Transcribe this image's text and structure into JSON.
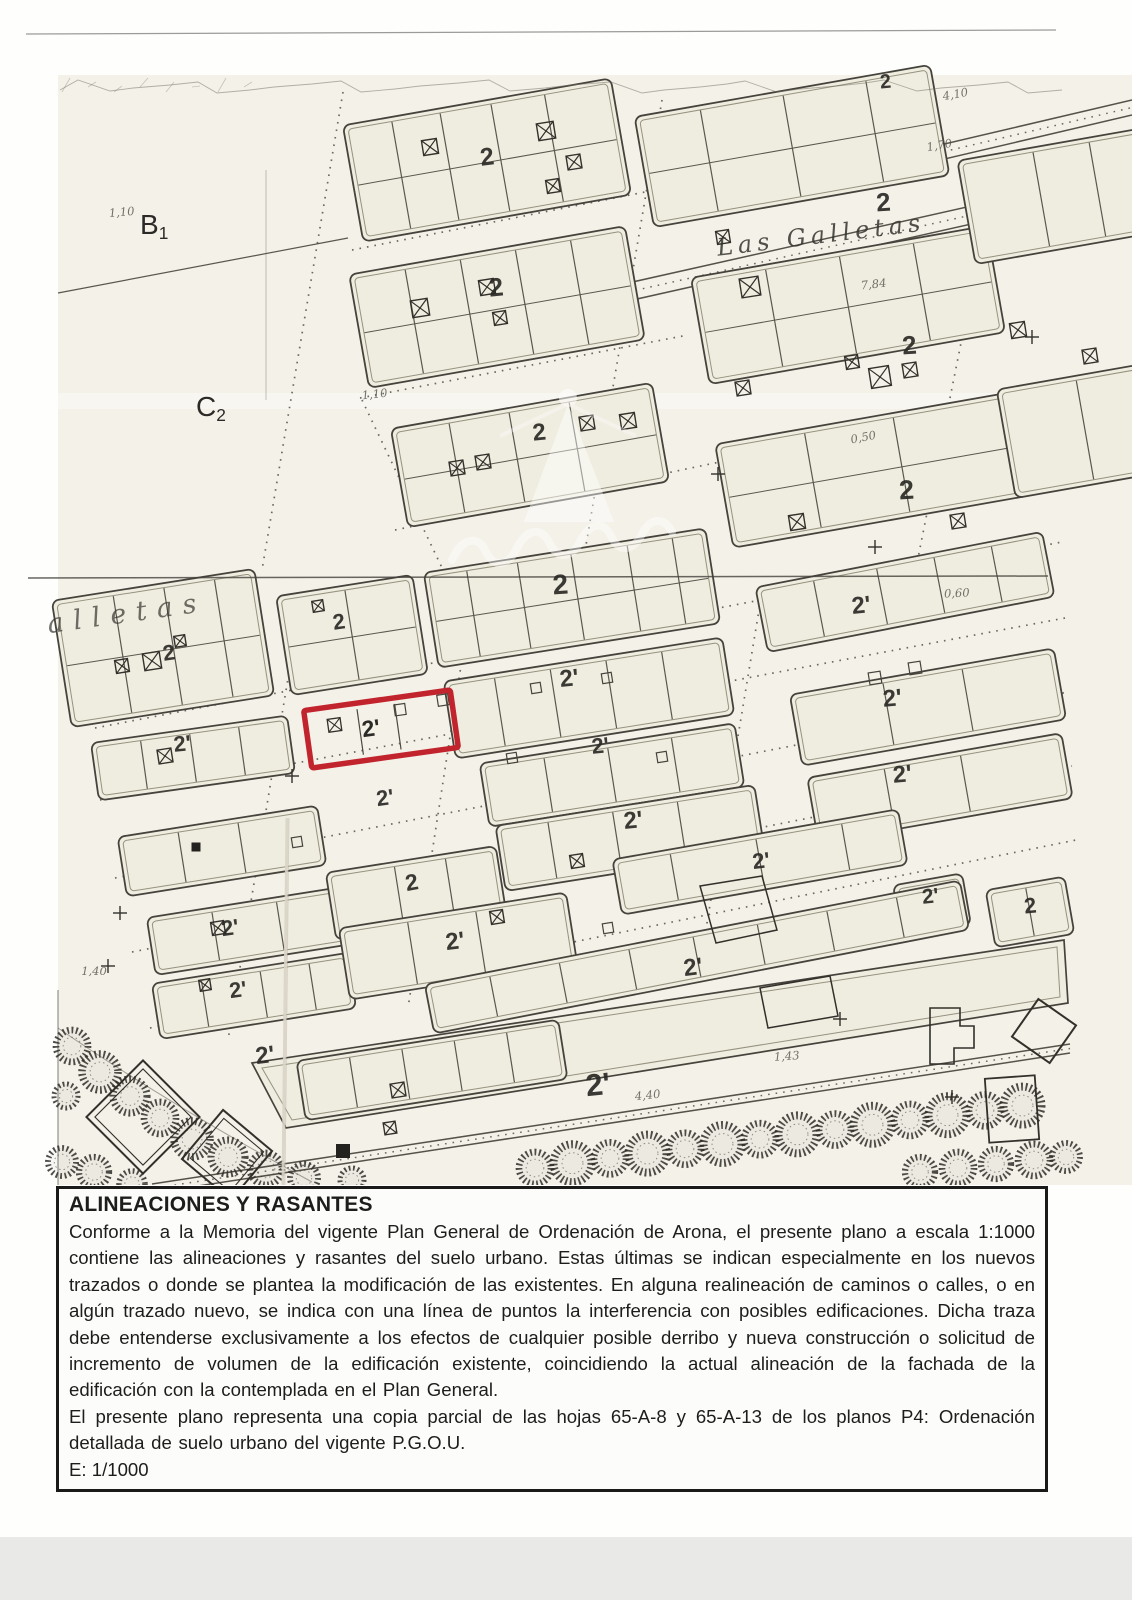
{
  "legend": {
    "title": "ALINEACIONES Y RASANTES",
    "body": "Conforme a la Memoria del vigente Plan General de Ordenación de Arona, el presente plano a escala 1:1000 contiene las alineaciones y rasantes del suelo urbano. Estas últimas se indican especialmente en los nuevos trazados o donde se plantea la modificación de las existentes. En alguna realineación de caminos o calles, o en algún trazado nuevo, se indica con una línea de puntos la interferencia con posibles edificaciones. Dicha traza debe entenderse exclusivamente a los efectos de cualquier posible derribo y nueva construcción o solicitud de incremento de volumen de la edificación existente, coincidiendo la actual alineación de la fachada de la edificación con la contemplada en el Plan General.",
    "note": "El presente plano representa una copia parcial de las hojas 65-A-8 y 65-A-13 de los planos P4: Ordenación detallada de suelo urbano del vigente P.G.O.U.",
    "scale": "E: 1/1000"
  },
  "map": {
    "highlight_color": "#c2242d",
    "street_labels": [
      {
        "text": "Las  Galletas",
        "x": 822,
        "y": 243,
        "fs": 24,
        "ls": 5,
        "rot": -7,
        "op": 0.85
      },
      {
        "text": "alletas",
        "x": 128,
        "y": 622,
        "fs": 27,
        "ls": 10,
        "rot": -8,
        "op": 0.7
      }
    ],
    "district_labels": [
      {
        "main": "B",
        "sub": "1",
        "x": 140,
        "y": 234,
        "fs": 28
      },
      {
        "main": "C",
        "sub": "2",
        "x": 196,
        "y": 416,
        "fs": 28
      }
    ],
    "zone_labels": [
      {
        "text": "2",
        "x": 886,
        "y": 88,
        "fs": 20,
        "rot": -5
      },
      {
        "text": "2",
        "x": 488,
        "y": 165,
        "fs": 25,
        "rot": -7
      },
      {
        "text": "2",
        "x": 884,
        "y": 211,
        "fs": 26,
        "rot": -4
      },
      {
        "text": "2",
        "x": 497,
        "y": 296,
        "fs": 26,
        "rot": -6
      },
      {
        "text": "2",
        "x": 910,
        "y": 354,
        "fs": 26,
        "rot": -4
      },
      {
        "text": "2",
        "x": 540,
        "y": 440,
        "fs": 24,
        "rot": -6
      },
      {
        "text": "2",
        "x": 907,
        "y": 499,
        "fs": 27,
        "rot": -3
      },
      {
        "text": "2",
        "x": 561,
        "y": 594,
        "fs": 28,
        "rot": -4
      },
      {
        "text": "2",
        "x": 340,
        "y": 629,
        "fs": 22,
        "rot": -8
      },
      {
        "text": "2",
        "x": 170,
        "y": 660,
        "fs": 22,
        "rot": -8
      },
      {
        "text": "2'",
        "x": 862,
        "y": 613,
        "fs": 24,
        "rot": -6
      },
      {
        "text": "2'",
        "x": 570,
        "y": 686,
        "fs": 24,
        "rot": -6
      },
      {
        "text": "2'",
        "x": 183,
        "y": 751,
        "fs": 22,
        "rot": -6
      },
      {
        "text": "2'",
        "x": 893,
        "y": 706,
        "fs": 24,
        "rot": -5
      },
      {
        "text": "2'",
        "x": 601,
        "y": 753,
        "fs": 22,
        "rot": -6
      },
      {
        "text": "2'",
        "x": 634,
        "y": 828,
        "fs": 24,
        "rot": -6
      },
      {
        "text": "2'",
        "x": 903,
        "y": 782,
        "fs": 24,
        "rot": -5
      },
      {
        "text": "2'",
        "x": 386,
        "y": 805,
        "fs": 22,
        "rot": -8
      },
      {
        "text": "2'",
        "x": 762,
        "y": 868,
        "fs": 22,
        "rot": -7
      },
      {
        "text": "2'",
        "x": 231,
        "y": 935,
        "fs": 22,
        "rot": -8
      },
      {
        "text": "2",
        "x": 413,
        "y": 890,
        "fs": 23,
        "rot": -10
      },
      {
        "text": "2'",
        "x": 456,
        "y": 949,
        "fs": 24,
        "rot": -7
      },
      {
        "text": "2'",
        "x": 239,
        "y": 997,
        "fs": 22,
        "rot": -8
      },
      {
        "text": "2'",
        "x": 931,
        "y": 903,
        "fs": 21,
        "rot": -6
      },
      {
        "text": "2",
        "x": 1031,
        "y": 913,
        "fs": 22,
        "rot": -6
      },
      {
        "text": "2'",
        "x": 694,
        "y": 975,
        "fs": 24,
        "rot": -7
      },
      {
        "text": "2'",
        "x": 266,
        "y": 1063,
        "fs": 24,
        "rot": -7
      },
      {
        "text": "2'",
        "x": 599,
        "y": 1095,
        "fs": 31,
        "rot": -6
      }
    ],
    "highlighted_parcel_label": {
      "text": "2'",
      "x": 372,
      "y": 736,
      "fs": 23,
      "rot": -8
    },
    "annotations": [
      {
        "text": "4,10",
        "x": 956,
        "y": 98,
        "rot": -10
      },
      {
        "text": "1,70",
        "x": 940,
        "y": 149,
        "rot": -10
      },
      {
        "text": "7,84",
        "x": 874,
        "y": 288,
        "rot": -6
      },
      {
        "text": "0,50",
        "x": 864,
        "y": 441,
        "rot": -11
      },
      {
        "text": "0,60",
        "x": 957,
        "y": 597,
        "rot": -3
      },
      {
        "text": "1,40",
        "x": 94,
        "y": 975,
        "rot": 0
      },
      {
        "text": "1,43",
        "x": 787,
        "y": 1060,
        "rot": -4
      },
      {
        "text": "4,40",
        "x": 648,
        "y": 1099,
        "rot": -6
      },
      {
        "text": "1,10",
        "x": 375,
        "y": 398,
        "rot": -6
      },
      {
        "text": "1,10",
        "x": 122,
        "y": 216,
        "rot": -5
      }
    ]
  }
}
